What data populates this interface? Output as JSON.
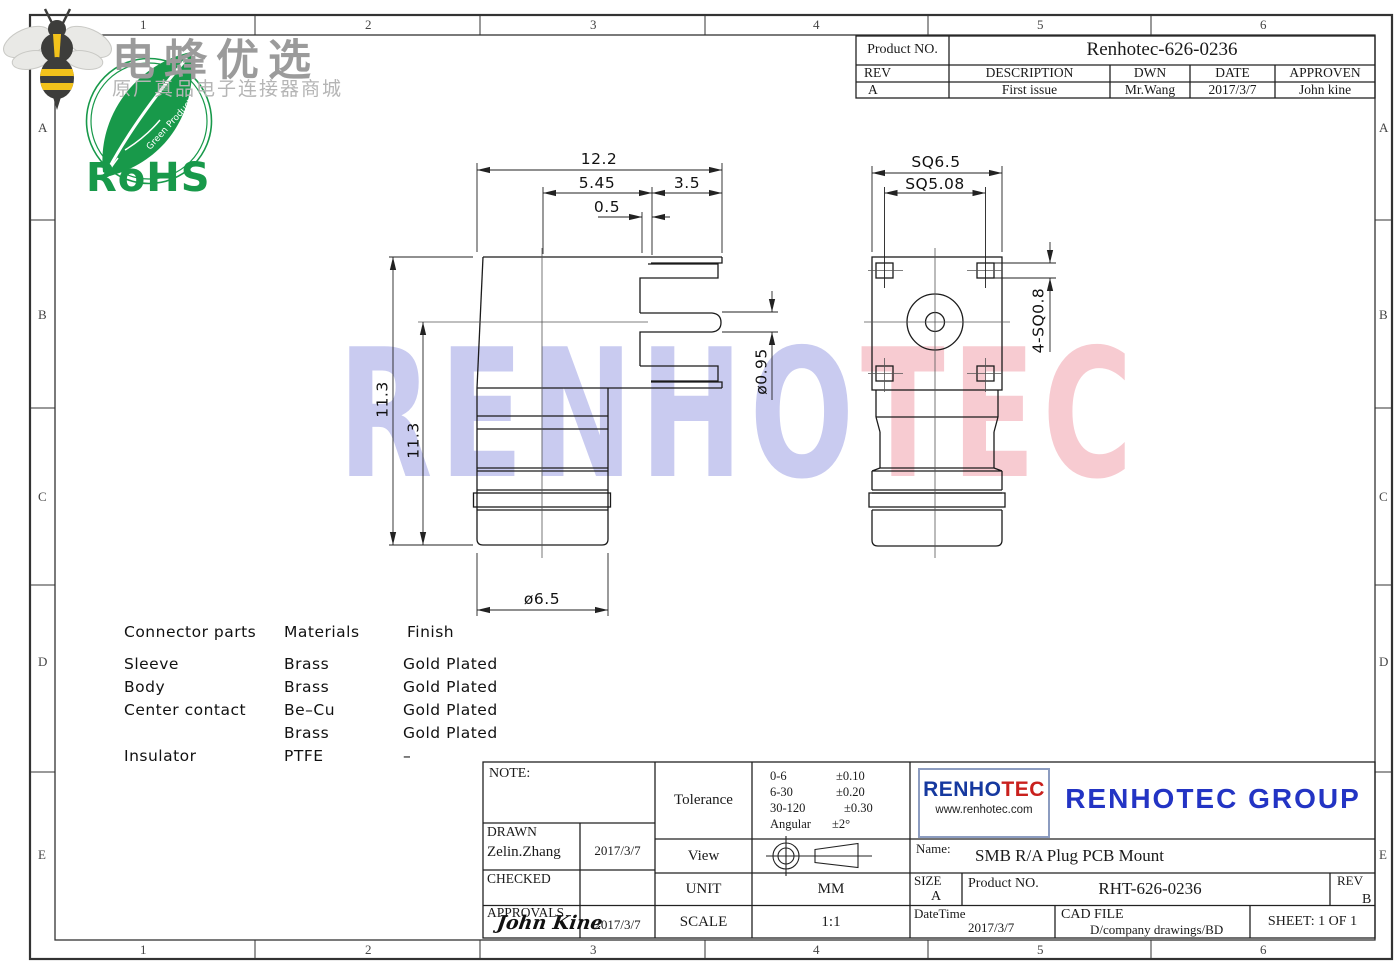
{
  "header_logo": {
    "brand": "电蜂优选",
    "slogan": "原厂真品电子连接器商城",
    "rohs": "RoHS",
    "rohs_sub": "Green Product",
    "rohs_green": "#18994a",
    "bee_yellow": "#f2c21b"
  },
  "watermark": {
    "part1": "RENHO",
    "part2": "TEC",
    "color1": "#c9cbf0",
    "color2": "#f7cbd1"
  },
  "frame": {
    "cols": [
      "1",
      "2",
      "3",
      "4",
      "5",
      "6"
    ],
    "rows": [
      "A",
      "B",
      "C",
      "D",
      "E"
    ]
  },
  "rev_table": {
    "product_label": "Product NO.",
    "product_value": "Renhotec-626-0236",
    "headers": [
      "REV",
      "DESCRIPTION",
      "DWN",
      "DATE",
      "APPROVEN"
    ],
    "row": [
      "A",
      "First issue",
      "Mr.Wang",
      "2017/3/7",
      "John kine"
    ]
  },
  "dims": {
    "total_width": "12.2",
    "body_width": "5.45",
    "leg_length": "3.5",
    "step": "0.5",
    "total_height": "14.5",
    "pin_to_bottom": "11.3",
    "pin_dia": "ø0.95",
    "barrel_dia": "ø6.5",
    "flange_sq": "SQ6.5",
    "pad_pitch": "SQ5.08",
    "pad_sq": "4-SQ0.8"
  },
  "materials": {
    "headers": {
      "part": "Connector parts",
      "material": "Materials",
      "finish": "Finish"
    },
    "rows": [
      {
        "part": "Sleeve",
        "material": "Brass",
        "finish": "Gold  Plated"
      },
      {
        "part": "Body",
        "material": "Brass",
        "finish": "Gold  Plated"
      },
      {
        "part": "Center  contact",
        "material": "Be–Cu",
        "finish": "Gold  Plated"
      },
      {
        "part": "",
        "material": "Brass",
        "finish": "Gold  Plated"
      },
      {
        "part": "Insulator",
        "material": "PTFE",
        "finish": "–"
      }
    ]
  },
  "title_block": {
    "note_label": "NOTE:",
    "drawn_label": "DRAWN",
    "drawn_name": "Zelin.Zhang",
    "drawn_date": "2017/3/7",
    "checked_label": "CHECKED",
    "approvals_label": "APPROVALS",
    "approvals_sign": "John Kine",
    "approvals_date": "2017/3/7",
    "tolerance_label": "Tolerance",
    "tolerance_rows": [
      {
        "range": "0-6",
        "tol": "±0.10"
      },
      {
        "range": "6-30",
        "tol": "±0.20"
      },
      {
        "range": "30-120",
        "tol": "±0.30"
      },
      {
        "range": "Angular",
        "tol": "±2°"
      }
    ],
    "view_label": "View",
    "unit_label": "UNIT",
    "unit_value": "MM",
    "scale_label": "SCALE",
    "scale_value": "1:1",
    "logo_name_1": "RENHO",
    "logo_name_2": "TEC",
    "logo_url": "www.renhotec.com",
    "company": "RENHOTEC GROUP",
    "name_label": "Name:",
    "name_value": "SMB R/A Plug PCB Mount",
    "size_label": "SIZE",
    "size_value": "A",
    "product_label": "Product NO.",
    "product_value": "RHT-626-0236",
    "rev_label": "REV",
    "rev_value": "B",
    "datetime_label": "DateTime",
    "datetime_value": "2017/3/7",
    "cadfile_label": "CAD FILE",
    "cadfile_value": "D/company drawings/BD",
    "sheet_value": "SHEET:  1 OF 1"
  }
}
